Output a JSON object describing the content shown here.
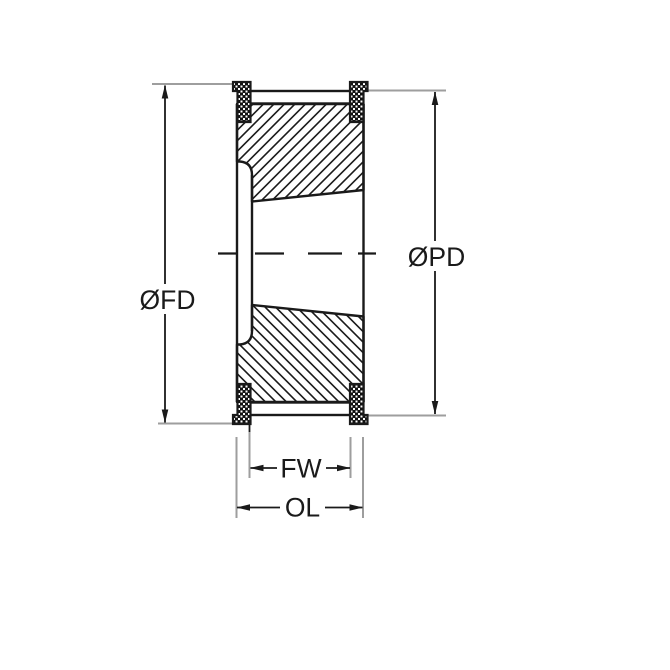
{
  "diagram": {
    "type": "technical-drawing",
    "subject": "timing-belt-pulley-cross-section",
    "labels": {
      "flange_diameter": "ØFD",
      "pitch_diameter": "ØPD",
      "face_width": "FW",
      "overall_length": "OL"
    },
    "colors": {
      "line": "#1a1a1a",
      "extension_line": "#9e9e9e",
      "background": "#ffffff"
    }
  }
}
